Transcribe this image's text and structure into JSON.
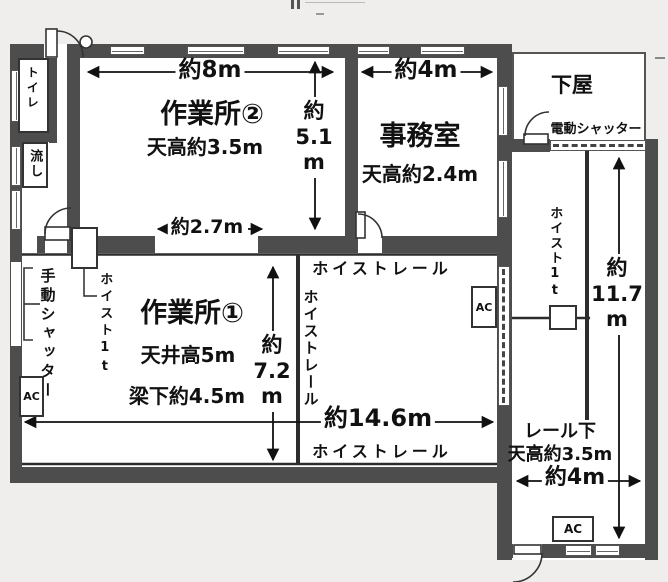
{
  "plan": {
    "rooms": {
      "workshop2": {
        "name": "作業所②",
        "ceiling": "天高約3.5m"
      },
      "office": {
        "name": "事務室",
        "ceiling": "天高約2.4m"
      },
      "workshop1": {
        "name": "作業所①",
        "ceiling": "天井高5m",
        "beam": "梁下約4.5m"
      },
      "toilet": "トイレ",
      "sink": "流し",
      "lean_to": "下屋",
      "under_rail": {
        "name": "レール下",
        "ceiling": "天高約3.5m"
      }
    },
    "equipment": {
      "manual_shutter": "手動シャッター",
      "electric_shutter": "電動シャッター",
      "hoist_left": "ホイスト1t",
      "hoist_right": "ホイスト1t",
      "rail_label_top": "ホイストレール",
      "rail_label_vertical": "ホイストレール",
      "rail_label_bottom": "ホイストレール",
      "ac": "AC"
    },
    "dimensions": {
      "ws2_width": "約8m",
      "office_width": "約4m",
      "opening_width": "約2.7m",
      "main_width": "約14.6m",
      "wing_width": "約4m",
      "ws2_depth": [
        "約",
        "5.1",
        "m"
      ],
      "ws1_depth": [
        "約",
        "7.2",
        "m"
      ],
      "wing_depth": [
        "約",
        "11.7",
        "m"
      ]
    },
    "colors": {
      "wall": "#4d4d4d",
      "line": "#2c2c2c",
      "paper": "#efeeec",
      "room": "#ffffff"
    }
  }
}
